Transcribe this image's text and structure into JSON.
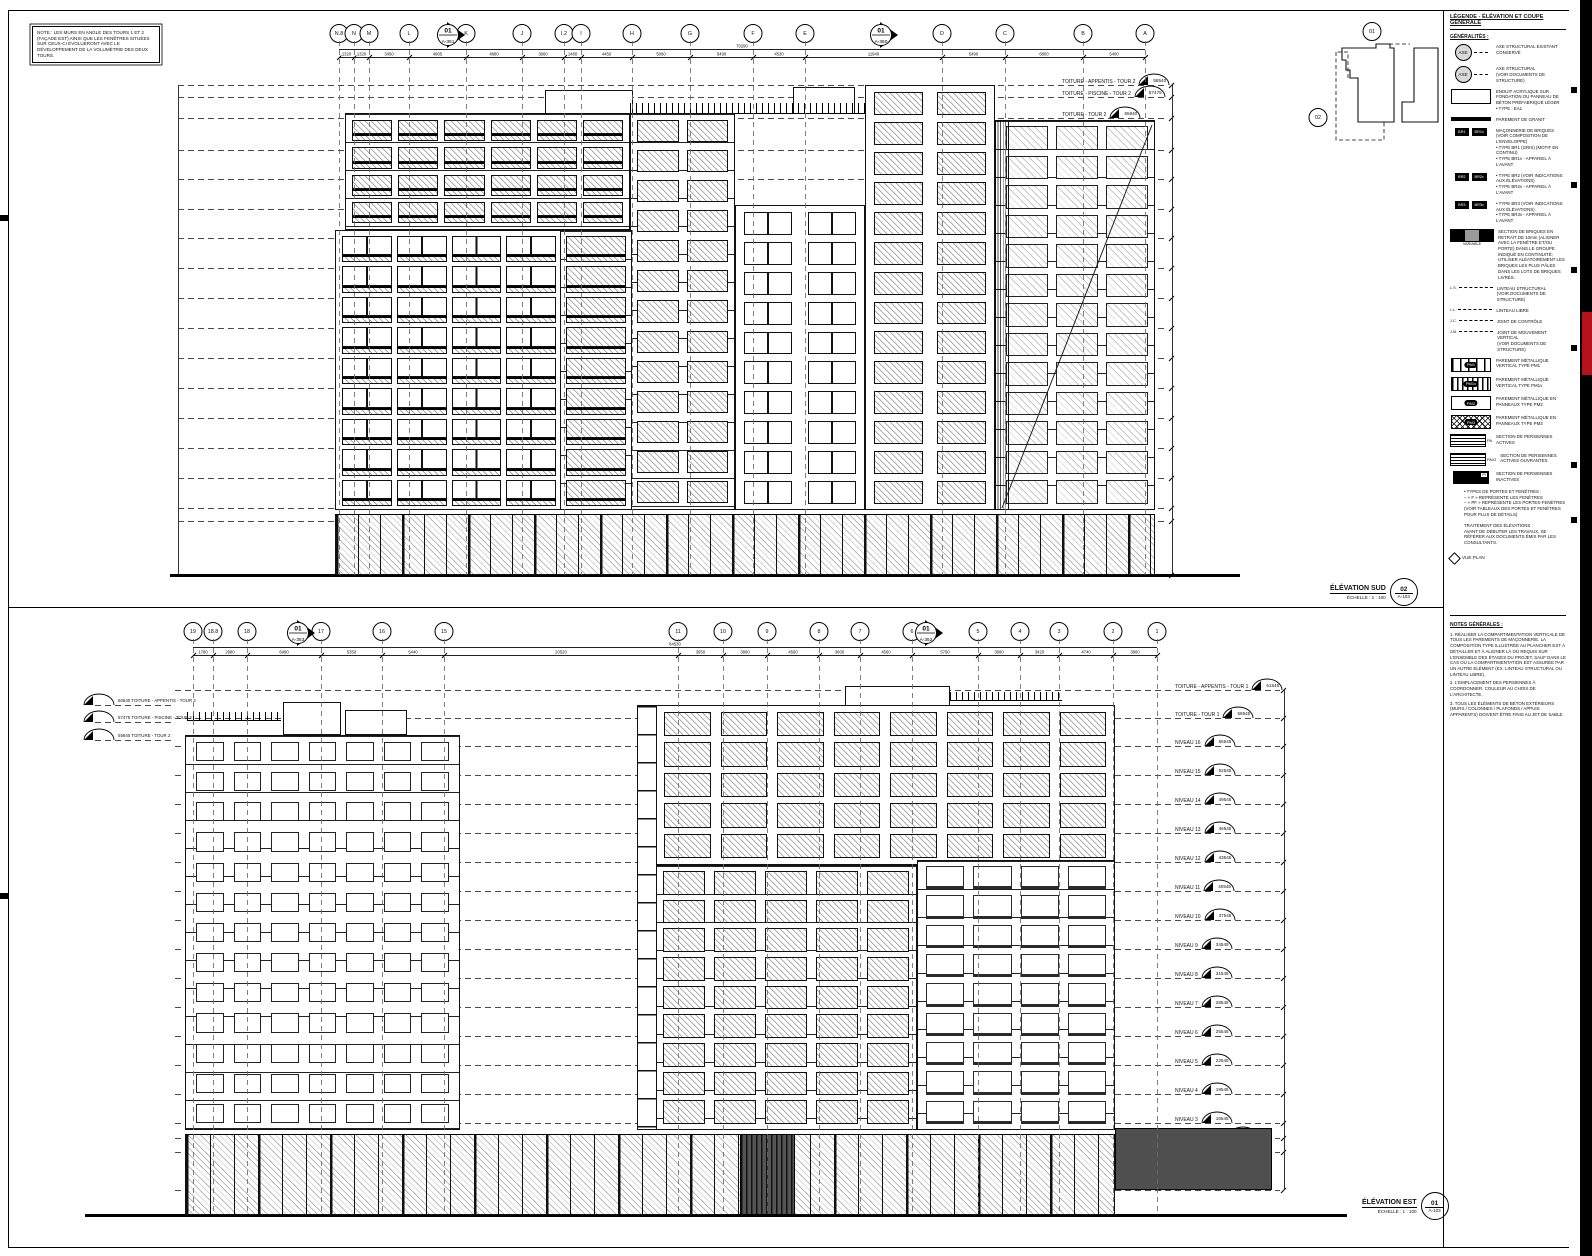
{
  "sheet": {
    "note_box": "NOTE : LES MURS EN ANGLE DES TOURS 1 ET 2 (FAÇADE EST) AINSI QUE LES FENÊTRES SITUÉES SUR CEUX-CI ÉVOLUERONT AVEC LE DÉVELOPPEMENT DE LA VOLUMÉTRIE DES DEUX TOURS.",
    "accent_red": "#b5121b"
  },
  "keyplan": {
    "marker_top": "01",
    "marker_left": "02"
  },
  "elevations": {
    "sud": {
      "title": "ÉLÉVATION SUD",
      "scale": "ÉCHELLE : 1 : 100",
      "detail_num": "02",
      "sheet_ref": "A-103",
      "grid": [
        {
          "label": "N.8",
          "x": 339
        },
        {
          "label": "N",
          "x": 354
        },
        {
          "label": "M",
          "x": 369
        },
        {
          "label": "L",
          "x": 409
        },
        {
          "label": "K",
          "x": 466
        },
        {
          "label": "J",
          "x": 522
        },
        {
          "label": "I.2",
          "x": 564
        },
        {
          "label": "I",
          "x": 581
        },
        {
          "label": "H",
          "x": 632
        },
        {
          "label": "G",
          "x": 690
        },
        {
          "label": "F",
          "x": 753
        },
        {
          "label": "E",
          "x": 805
        },
        {
          "label": "D",
          "x": 942
        },
        {
          "label": "C",
          "x": 1005
        },
        {
          "label": "B",
          "x": 1083
        },
        {
          "label": "A",
          "x": 1145
        }
      ],
      "flags": [
        {
          "num": "01",
          "sheet": "A-351",
          "x": 447
        },
        {
          "num": "01",
          "sheet": "A-350",
          "x": 880
        }
      ],
      "overall_dim": "70290",
      "dims": [
        {
          "x1": 339,
          "x2": 354,
          "v": "1320"
        },
        {
          "x1": 354,
          "x2": 369,
          "v": "1320"
        },
        {
          "x1": 369,
          "x2": 409,
          "v": "3450"
        },
        {
          "x1": 409,
          "x2": 466,
          "v": "4905"
        },
        {
          "x1": 466,
          "x2": 522,
          "v": "4880"
        },
        {
          "x1": 522,
          "x2": 564,
          "v": "3660"
        },
        {
          "x1": 564,
          "x2": 581,
          "v": "1480"
        },
        {
          "x1": 581,
          "x2": 632,
          "v": "4450"
        },
        {
          "x1": 632,
          "x2": 690,
          "v": "5060"
        },
        {
          "x1": 690,
          "x2": 753,
          "v": "5490"
        },
        {
          "x1": 753,
          "x2": 805,
          "v": "4530"
        },
        {
          "x1": 805,
          "x2": 942,
          "v": "11940"
        },
        {
          "x1": 942,
          "x2": 1005,
          "v": "5490"
        },
        {
          "x1": 1005,
          "x2": 1083,
          "v": "6800"
        },
        {
          "x1": 1083,
          "x2": 1145,
          "v": "5400"
        }
      ],
      "levels": [
        {
          "label": "TOITURE - APPENTIS - TOUR 2",
          "value": "58540",
          "y": 85
        },
        {
          "label": "TOITURE - PISCINE - TOUR 2",
          "value": "57475",
          "y": 97
        },
        {
          "label": "TOITURE - TOUR 2",
          "value": "55940",
          "y": 118
        },
        {
          "label": "NIVEAU 14",
          "value": "52940",
          "y": 150
        },
        {
          "label": "NIVEAU 13",
          "value": "49940",
          "y": 179
        },
        {
          "label": "NIVEAU 12",
          "value": "46940",
          "y": 209
        },
        {
          "label": "NIVEAU 11",
          "value": "43940",
          "y": 238
        },
        {
          "label": "NIVEAU 10",
          "value": "40940",
          "y": 268
        },
        {
          "label": "NIVEAU 9",
          "value": "37940",
          "y": 298
        },
        {
          "label": "NIVEAU 8",
          "value": "34940",
          "y": 328
        },
        {
          "label": "NIVEAU 7",
          "value": "31940",
          "y": 358
        },
        {
          "label": "NIVEAU 6",
          "value": "28940",
          "y": 388
        },
        {
          "label": "NIVEAU 5",
          "value": "25940",
          "y": 418
        },
        {
          "label": "NIVEAU 4",
          "value": "22940",
          "y": 448
        },
        {
          "label": "NIVEAU 3",
          "value": "19940",
          "y": 478
        },
        {
          "label": "NIVEAU 2",
          "value": "16940",
          "y": 508
        },
        {
          "label": "TOITURE - NIVEAU 1",
          "value": "16280",
          "y": 521
        },
        {
          "label": "NIVEAU 1",
          "value": "10940",
          "y": 575
        }
      ]
    },
    "est": {
      "title": "ÉLÉVATION EST",
      "scale": "ÉCHELLE : 1 : 100",
      "detail_num": "01",
      "sheet_ref": "A-103",
      "grid": [
        {
          "label": "19",
          "x": 193
        },
        {
          "label": "18.8",
          "x": 213
        },
        {
          "label": "18",
          "x": 247
        },
        {
          "label": "17",
          "x": 321
        },
        {
          "label": "16",
          "x": 382
        },
        {
          "label": "15",
          "x": 444
        },
        {
          "label": "11",
          "x": 678
        },
        {
          "label": "10",
          "x": 723
        },
        {
          "label": "9",
          "x": 767
        },
        {
          "label": "8",
          "x": 819
        },
        {
          "label": "7",
          "x": 860
        },
        {
          "label": "6",
          "x": 912
        },
        {
          "label": "5",
          "x": 978
        },
        {
          "label": "4",
          "x": 1020
        },
        {
          "label": "3",
          "x": 1059
        },
        {
          "label": "2",
          "x": 1113
        },
        {
          "label": "1",
          "x": 1157
        }
      ],
      "flags": [
        {
          "num": "01",
          "sheet": "A-353",
          "x": 297
        },
        {
          "num": "01",
          "sheet": "A-352",
          "x": 925
        }
      ],
      "overall_dim": "84530",
      "dims": [
        {
          "x1": 193,
          "x2": 213,
          "v": "1780"
        },
        {
          "x1": 213,
          "x2": 247,
          "v": "2980"
        },
        {
          "x1": 247,
          "x2": 321,
          "v": "6490"
        },
        {
          "x1": 321,
          "x2": 382,
          "v": "5350"
        },
        {
          "x1": 382,
          "x2": 444,
          "v": "5440"
        },
        {
          "x1": 444,
          "x2": 678,
          "v": "20520"
        },
        {
          "x1": 678,
          "x2": 723,
          "v": "3950"
        },
        {
          "x1": 723,
          "x2": 767,
          "v": "3860"
        },
        {
          "x1": 767,
          "x2": 819,
          "v": "4560"
        },
        {
          "x1": 819,
          "x2": 860,
          "v": "3600"
        },
        {
          "x1": 860,
          "x2": 912,
          "v": "4560"
        },
        {
          "x1": 912,
          "x2": 978,
          "v": "5790"
        },
        {
          "x1": 978,
          "x2": 1020,
          "v": "3680"
        },
        {
          "x1": 1020,
          "x2": 1059,
          "v": "3420"
        },
        {
          "x1": 1059,
          "x2": 1113,
          "v": "4740"
        },
        {
          "x1": 1113,
          "x2": 1157,
          "v": "3860"
        }
      ],
      "levels": [
        {
          "label": "TOITURE - APPENTIS - TOUR 1",
          "value": "61545",
          "y": 690
        },
        {
          "label": "TOITURE - TOUR 1",
          "value": "58545",
          "y": 718
        },
        {
          "label": "NIVEAU 16",
          "value": "55545",
          "y": 746
        },
        {
          "label": "NIVEAU 15",
          "value": "52545",
          "y": 775
        },
        {
          "label": "NIVEAU 14",
          "value": "49545",
          "y": 804
        },
        {
          "label": "NIVEAU 13",
          "value": "46545",
          "y": 833
        },
        {
          "label": "NIVEAU 12",
          "value": "43545",
          "y": 862
        },
        {
          "label": "NIVEAU 11",
          "value": "40545",
          "y": 891
        },
        {
          "label": "NIVEAU 10",
          "value": "37545",
          "y": 920
        },
        {
          "label": "NIVEAU 9",
          "value": "34545",
          "y": 949
        },
        {
          "label": "NIVEAU 8",
          "value": "31545",
          "y": 978
        },
        {
          "label": "NIVEAU 7",
          "value": "28545",
          "y": 1007
        },
        {
          "label": "NIVEAU 6",
          "value": "25545",
          "y": 1036
        },
        {
          "label": "NIVEAU 5",
          "value": "22545",
          "y": 1065
        },
        {
          "label": "NIVEAU 4",
          "value": "19545",
          "y": 1094
        },
        {
          "label": "NIVEAU 3",
          "value": "16545",
          "y": 1123
        },
        {
          "label": "TOITURE - NIVEAU 1",
          "value": "16280",
          "y": 1138
        },
        {
          "label": "NIVEAU 2",
          "value": "13940",
          "y": 1152
        },
        {
          "label": "NIVEAU 1",
          "value": "10940",
          "y": 1190
        }
      ],
      "left_levels": [
        {
          "value": "60640",
          "label": "TOITURE - APPENTIS - TOUR 2",
          "y": 705
        },
        {
          "value": "57475",
          "label": "TOITURE - PISCINE - TOUR 2",
          "y": 722
        },
        {
          "value": "55940",
          "label": "TOITURE - TOUR 2",
          "y": 740
        }
      ]
    }
  },
  "legend": {
    "title": "LÉGENDE - ÉLÉVATION ET COUPE GÉNÉRALE",
    "section": "GÉNÉRALITÉS :",
    "keyref": "VUE PLAN",
    "items": [
      {
        "type": "axe",
        "sym": "AXE",
        "label": "AXE STRUCTURAL EXISTANT CONSERVÉ"
      },
      {
        "type": "axe",
        "sym": "AXE",
        "label": "AXE STRUCTURAL\n(VOIR DOCUMENTS DE STRUCTURE)"
      },
      {
        "type": "stipple",
        "label": "ENDUIT ACRYLIQUE SUR FONDATION OU PANNEAU DE BÉTON PRÉFABRIQUÉ LÉGER\n• TYPE : EA1"
      },
      {
        "type": "granit",
        "label": "PAREMENT DE GRANIT"
      },
      {
        "type": "brick",
        "tags": [
          "BR1",
          "BR1v"
        ],
        "label": "MAÇONNERIE DE BRIQUES (VOIR COMPOSITION DE L'ENVELOPPE)\n• TYPE BR1 (GRIS) (MOTIF EN CONTINU)\n• TYPE BR1v - APPAREIL À L'AVANT"
      },
      {
        "type": "brick",
        "tags": [
          "BR2",
          "BR2v"
        ],
        "label": "• TYPE BR2 (VOIR INDICATIONS AUX ÉLÉVATIONS)\n• TYPE BR2v - APPAREIL À L'AVANT"
      },
      {
        "type": "brick",
        "tags": [
          "BR3",
          "BR3v"
        ],
        "label": "• TYPE BR3 (VOIR INDICATIONS AUX ÉLÉVATIONS)\n• TYPE BR3v - APPAREIL À L'AVANT"
      },
      {
        "type": "brickmix",
        "sub": "VARIABLE",
        "label": "SECTION DE BRIQUES EN RETRAIT DE 10mm (ALIGNER AVEC LA FENÊTRE ET/OU PORTE) DANS LE GROUPE INDIQUÉ EN CONTINUITÉ; UTILISER ALÉATOIREMENT LES BRIQUES LES PLUS PÂLES DANS LES LOTS DE BRIQUES LIVRÉS."
      },
      {
        "type": "line",
        "sym": "L.S.",
        "label": "LINTEAU STRUCTURAL\n(VOIR DOCUMENTS DE STRUCTURE)"
      },
      {
        "type": "line",
        "sym": "L.L.",
        "label": "LINTEAU LIBRE"
      },
      {
        "type": "line",
        "sym": "J.C.",
        "label": "JOINT DE CONTRÔLE"
      },
      {
        "type": "line",
        "sym": "J.M.",
        "label": "JOINT DE MOUVEMENT VERTICAL\n(VOIR DOCUMENTS DE STRUCTURE)"
      },
      {
        "type": "pm1",
        "tag": "PM1",
        "label": "PAREMENT MÉTALLIQUE VERTICAL TYPE PM1"
      },
      {
        "type": "pm1v",
        "tag": "PM1v",
        "label": "PAREMENT MÉTALLIQUE VERTICAL TYPE PM1v"
      },
      {
        "type": "pm2",
        "tag": "PM2",
        "label": "PAREMENT MÉTALLIQUE EN PANNEAUX TYPE PM2"
      },
      {
        "type": "pm3",
        "tag": "PM3",
        "label": "PAREMENT MÉTALLIQUE EN PANNEAUX TYPE PM3"
      },
      {
        "type": "pa",
        "tag": "PA",
        "label": "SECTION DE PERSIENNES ACTIVES"
      },
      {
        "type": "pa",
        "tag": "PA/O",
        "label": "SECTION DE PERSIENNES ACTIVES OUVRANTES"
      },
      {
        "type": "pi",
        "tag": "PI",
        "label": "SECTION DE PERSIENNES INACTIVES"
      },
      {
        "type": "text",
        "label": "• TYPES DE PORTES ET FENÊTRES :\n– « F » REPRÉSENTE LES FENÊTRES\n– « PF » REPRÉSENTE LES PORTES-FENÊTRES\n(VOIR TABLEAUX DES PORTES ET FENÊTRES POUR PLUS DE DÉTAILS)"
      },
      {
        "type": "text",
        "label": "TRAITEMENT DES ÉLÉVATIONS :\nAVANT DE DÉBUTER LES TRAVAUX, SE RÉFÉRER AUX DOCUMENTS ÉMIS PAR LES CONSULTANTS."
      }
    ],
    "notes_title": "NOTES GÉNÉRALES :",
    "notes": [
      "1. RÉALISER LA COMPARTIMENTATION VERTICALE DE TOUS LES PAREMENTS DE MAÇONNERIE. LA COMPOSITION TYPE ILLUSTRÉE AU PLANCHER EST À DÉTAILLER ET À ALIGNER LÀ OÙ REQUIS SUR L'ENSEMBLE DES ÉTAGES DU PROJET, SAUF DANS LE CAS OÙ LA COMPARTIMENTATION EST ASSURÉE PAR UN AUTRE ÉLÉMENT (EX. LINTEAU STRUCTURAL OU LINTEAU LIBRE).",
      "2. L'EMPLACEMENT DES PERSIENNES À COORDONNER, COULEUR AU CHOIX DE L'ARCHITECTE.",
      "3. TOUS LES ÉLÉMENTS DE BÉTON EXTÉRIEURS (MURS / COLONNES / PLAFONDS / APPUIS APPARENTS) DOIVENT ÊTRE FINIS AU JET DE SABLE."
    ]
  }
}
